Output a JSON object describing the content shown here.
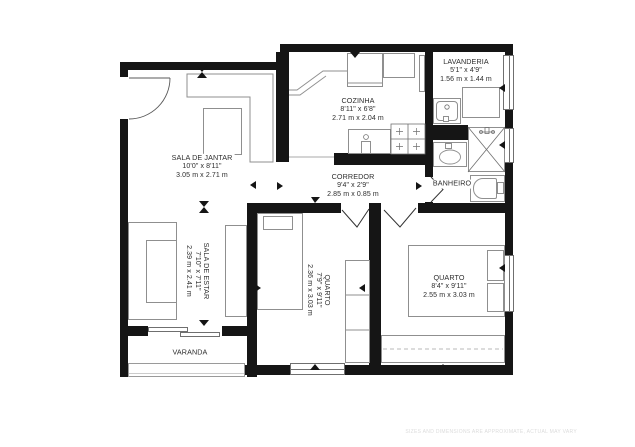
{
  "rooms": {
    "sala_de_jantar": {
      "name": "SALA DE JANTAR",
      "imperial": "10'0\" x 8'11\"",
      "metric": "3.05 m x 2.71 m"
    },
    "cozinha": {
      "name": "COZINHA",
      "imperial": "8'11\" x 6'8\"",
      "metric": "2.71 m x 2.04 m"
    },
    "lavanderia": {
      "name": "LAVANDERIA",
      "imperial": "5'1\" x 4'9\"",
      "metric": "1.56 m x 1.44 m"
    },
    "corredor": {
      "name": "CORREDOR",
      "imperial": "9'4\" x 2'9\"",
      "metric": "2.85 m x 0.85 m"
    },
    "banheiro": {
      "name": "BANHEIRO"
    },
    "sala_de_estar": {
      "name": "SALA DE ESTAR",
      "imperial": "7'10\" x 7'11\"",
      "metric": "2.39 m x 2.41 m"
    },
    "quarto_1": {
      "name": "QUARTO",
      "imperial": "7'9\" x 9'11\"",
      "metric": "2.36 m x 3.03 m"
    },
    "quarto_2": {
      "name": "QUARTO",
      "imperial": "8'4\" x 9'11\"",
      "metric": "2.55 m x 3.03 m"
    },
    "varanda": {
      "name": "VARANDA"
    }
  },
  "footer": {
    "disclaimer": "SIZES AND DIMENSIONS ARE APPROXIMATE, ACTUAL MAY VARY"
  },
  "colors": {
    "wall": "#151515",
    "fixture_line": "#8f8f8f",
    "label_text": "#2d2d2d",
    "disclaimer_text": "#dcdcdc"
  },
  "fixtures": [
    "entry-door-arc",
    "dining-table",
    "kitchen-cabinet",
    "fridge",
    "kitchen-counter",
    "stove",
    "kitchen-sink",
    "washing-machine",
    "laundry-counter",
    "shower",
    "bathroom-sink",
    "bathtub",
    "sofa",
    "tv-stand",
    "bed",
    "pillow",
    "wardrobe",
    "sliding-door",
    "window",
    "balcony-railing"
  ]
}
